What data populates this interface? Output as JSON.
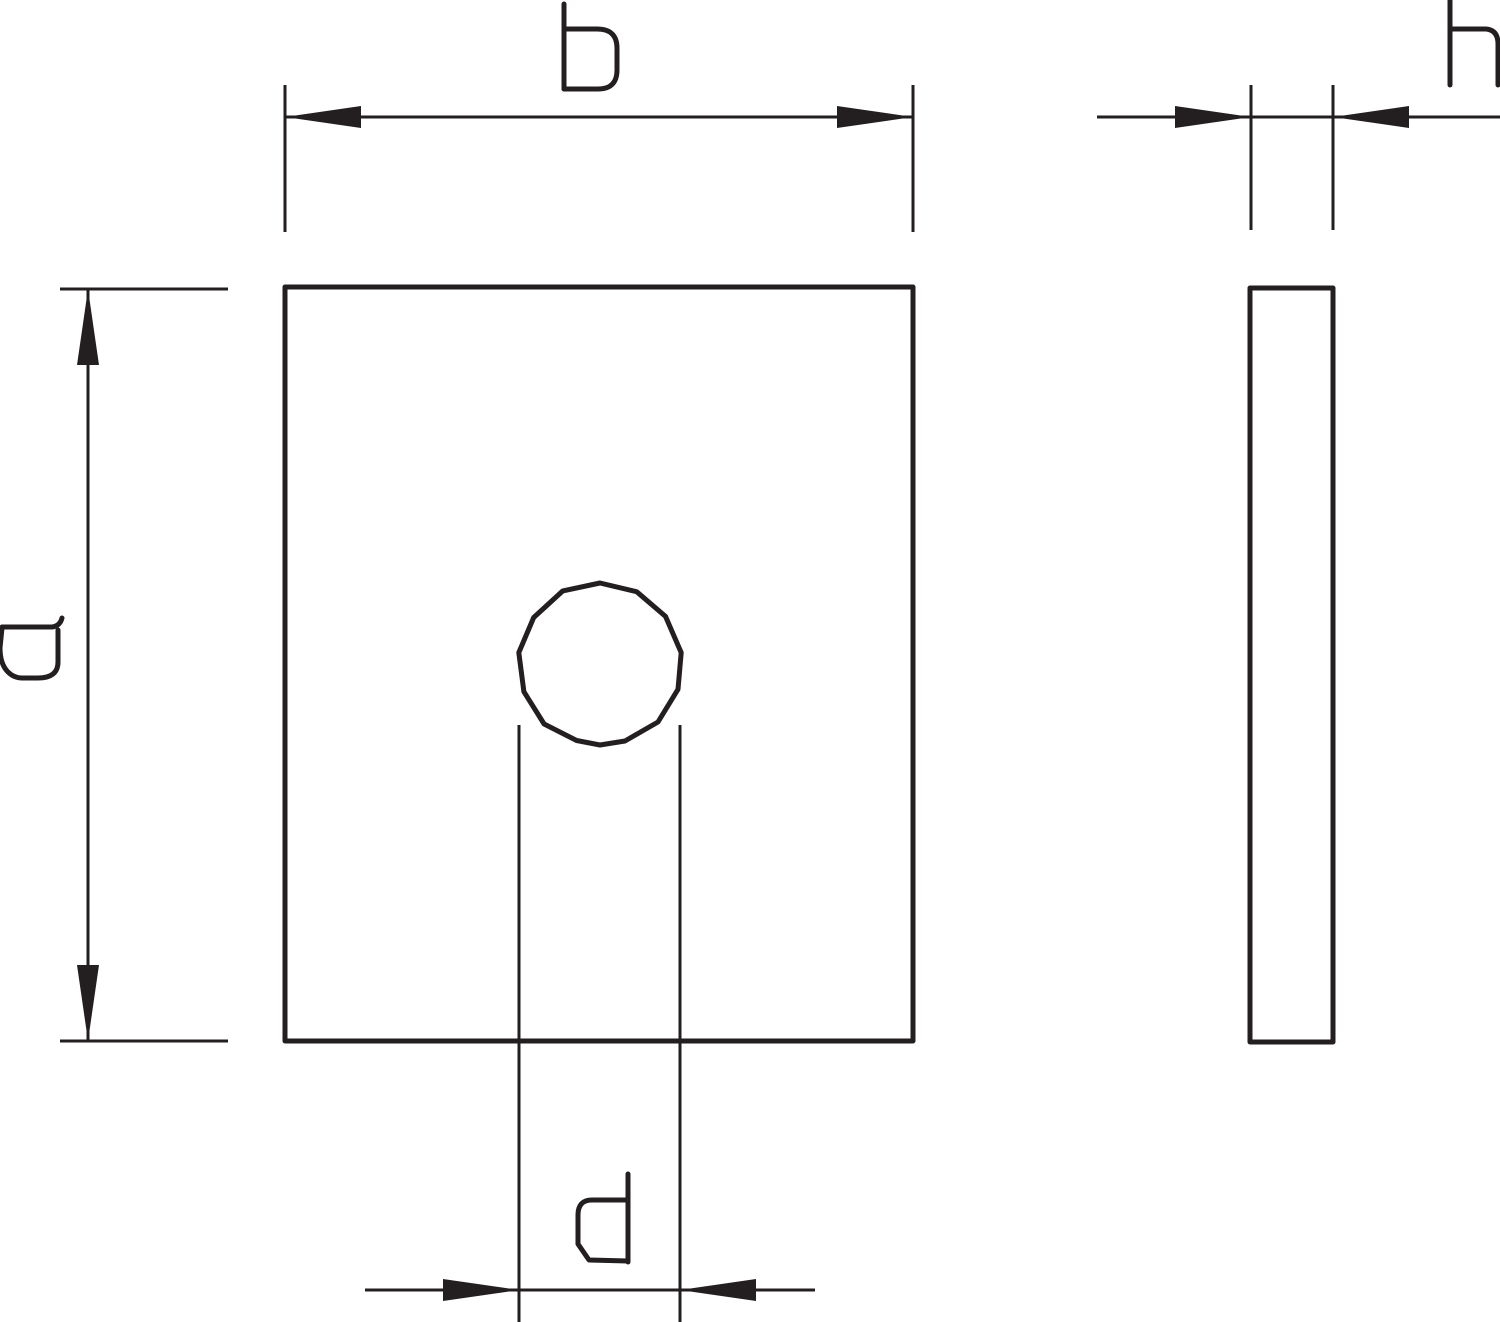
{
  "drawing": {
    "labels": {
      "width": "b",
      "thickness": "h",
      "height": "a",
      "hole_diameter": "d"
    },
    "colors": {
      "line": "#231f20",
      "background": "#ffffff"
    }
  }
}
